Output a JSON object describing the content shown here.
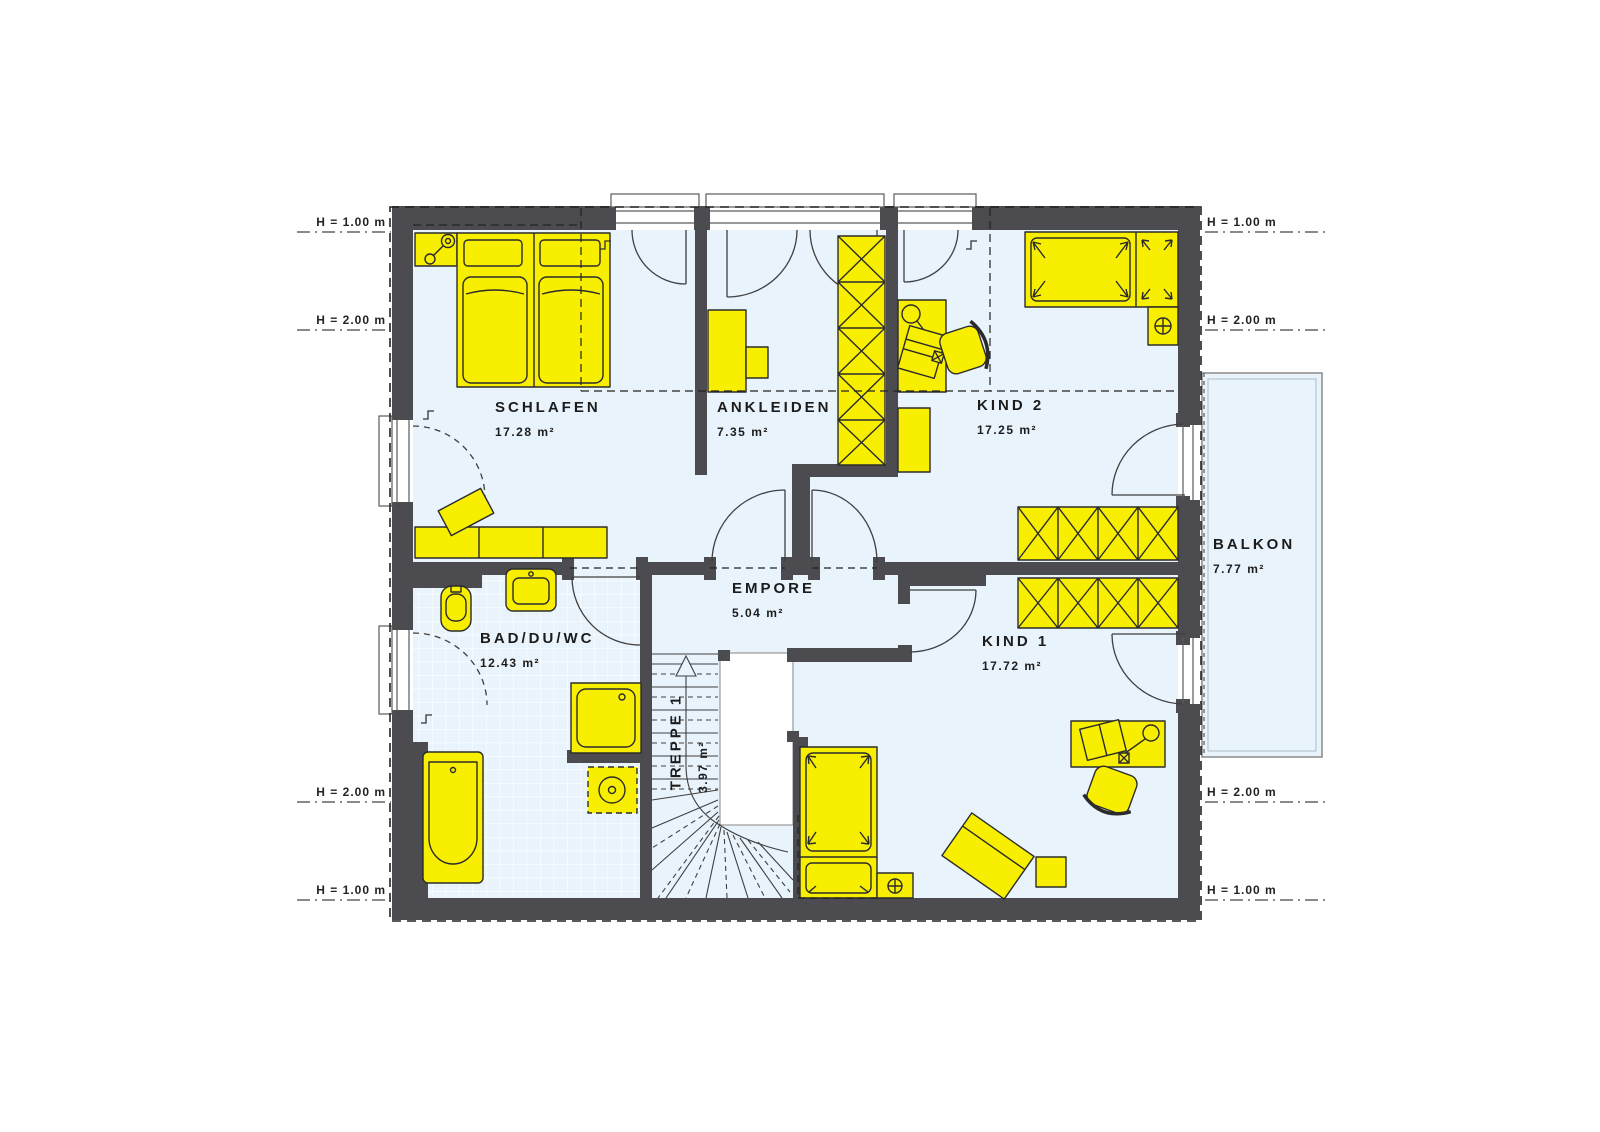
{
  "plan_title": "Dachgeschoss Grundriss",
  "rooms": {
    "schlafen": {
      "name": "SCHLAFEN",
      "area": "17.28 m²"
    },
    "ankleiden": {
      "name": "ANKLEIDEN",
      "area": "7.35 m²"
    },
    "kind2": {
      "name": "KIND 2",
      "area": "17.25 m²"
    },
    "empore": {
      "name": "EMPORE",
      "area": "5.04 m²"
    },
    "bad": {
      "name": "BAD/DU/WC",
      "area": "12.43 m²"
    },
    "treppe": {
      "name": "TREPPE 1",
      "area": "3.97 m²"
    },
    "kind1": {
      "name": "KIND 1",
      "area": "17.72 m²"
    },
    "balkon": {
      "name": "BALKON",
      "area": "7.77 m²"
    }
  },
  "height_markers": {
    "h100": "H = 1.00 m",
    "h200": "H = 2.00 m"
  },
  "colors": {
    "wall": "#4c4c50",
    "floor": "#e9f3fb",
    "furniture": "#f8ef00",
    "line": "#2b2b2b",
    "text": "#1c1c1c"
  }
}
